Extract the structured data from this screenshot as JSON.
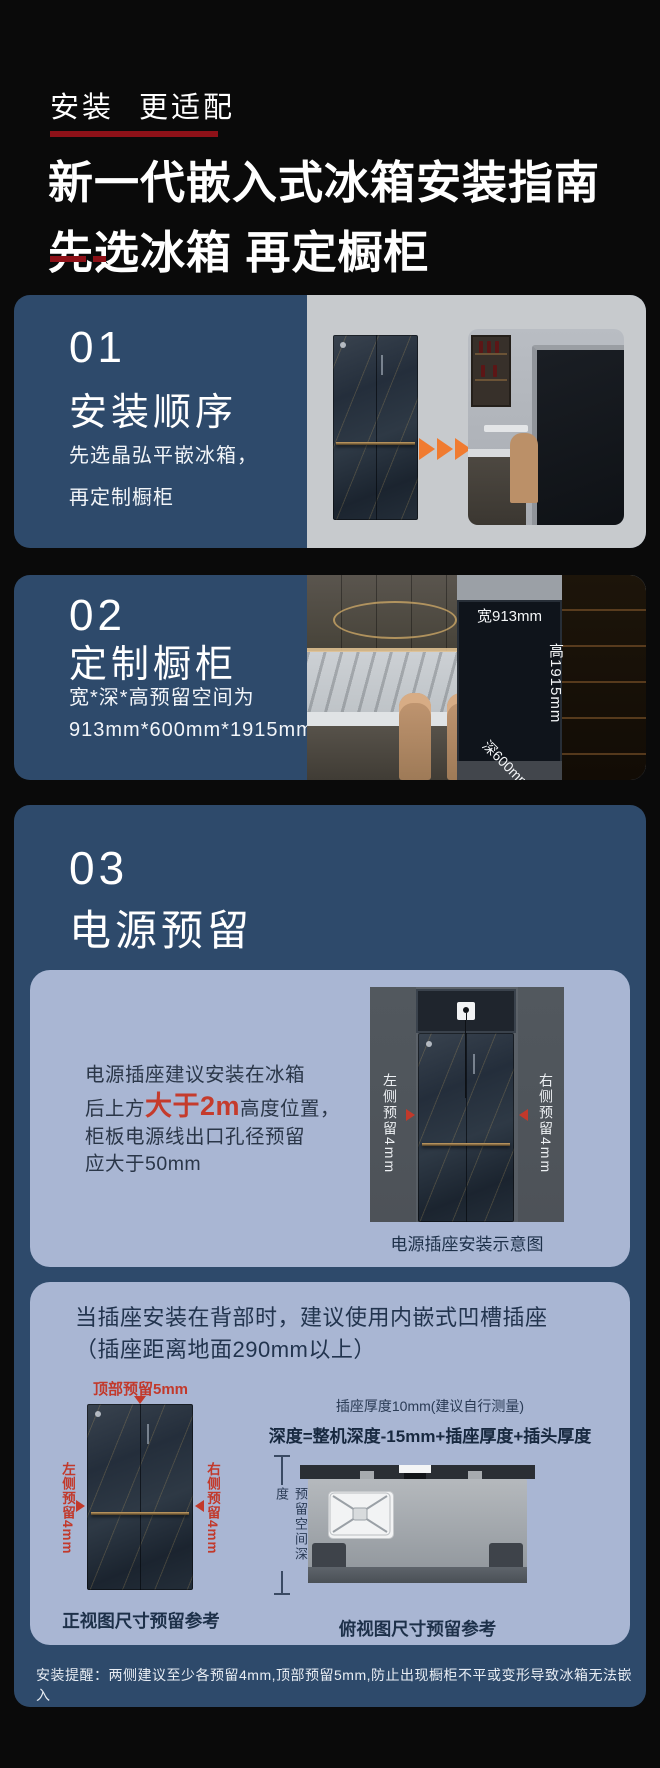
{
  "theme": {
    "background": "#0A0A0A",
    "card_blue": "#2E4A6B",
    "subcard_blue": "#A9B6D3",
    "dark_red": "#8E1118",
    "accent_red": "#C2392B",
    "orange_arrow": "#F07B30",
    "panel_gray": "#5A6067",
    "caption_navy": "#1D3049"
  },
  "header": {
    "kicker": "安装 更适配",
    "title_line1": "新一代嵌入式冰箱安装指南",
    "title_line2": "先选冰箱 再定橱柜"
  },
  "step1": {
    "number": "01",
    "title": "安装顺序",
    "desc_line1": "先选晶弘平嵌冰箱，",
    "desc_line2": "再定制橱柜"
  },
  "step2": {
    "number": "02",
    "title": "定制橱柜",
    "desc_line1": "宽*深*高预留空间为",
    "desc_line2": "913mm*600mm*1915mm",
    "scene_labels": {
      "width": "宽913mm",
      "height": "高1915mm",
      "depth": "深600mm"
    }
  },
  "step3": {
    "number": "03",
    "title": "电源预留",
    "socket_panel": {
      "line1": "电源插座建议安装在冰箱",
      "line2_pre": "后上方",
      "line2_em": "大于2m",
      "line2_post": "高度位置，",
      "line3": "柜板电源线出口孔径预留",
      "line4": "应大于50mm",
      "label_left": "左侧预留4mm",
      "label_right": "右侧预留4mm",
      "caption": "电源插座安装示意图"
    },
    "recess_panel": {
      "title_line1": "当插座安装在背部时，建议使用内嵌式凹槽插座",
      "title_line2": "（插座距离地面290mm以上）",
      "front_view": {
        "top_label": "顶部预留5mm",
        "left_label": "左侧预留4mm",
        "right_label": "右侧预留4mm",
        "caption": "正视图尺寸预留参考"
      },
      "top_view": {
        "note": "插座厚度10mm(建议自行测量)",
        "formula": "深度=整机深度-15mm+插座厚度+插头厚度",
        "depth_label": "预留空间深度",
        "caption": "俯视图尺寸预留参考"
      }
    },
    "footnote": "安装提醒：两侧建议至少各预留4mm,顶部预留5mm,防止出现橱柜不平或变形导致冰箱无法嵌入"
  },
  "icons": {
    "forward_arrow": "orange right triangle x3",
    "marker_right": "red right triangle",
    "marker_left": "red left triangle",
    "marker_down": "red down triangle",
    "socket": "white outlet square",
    "dimension_line": "vertical line with end caps"
  }
}
